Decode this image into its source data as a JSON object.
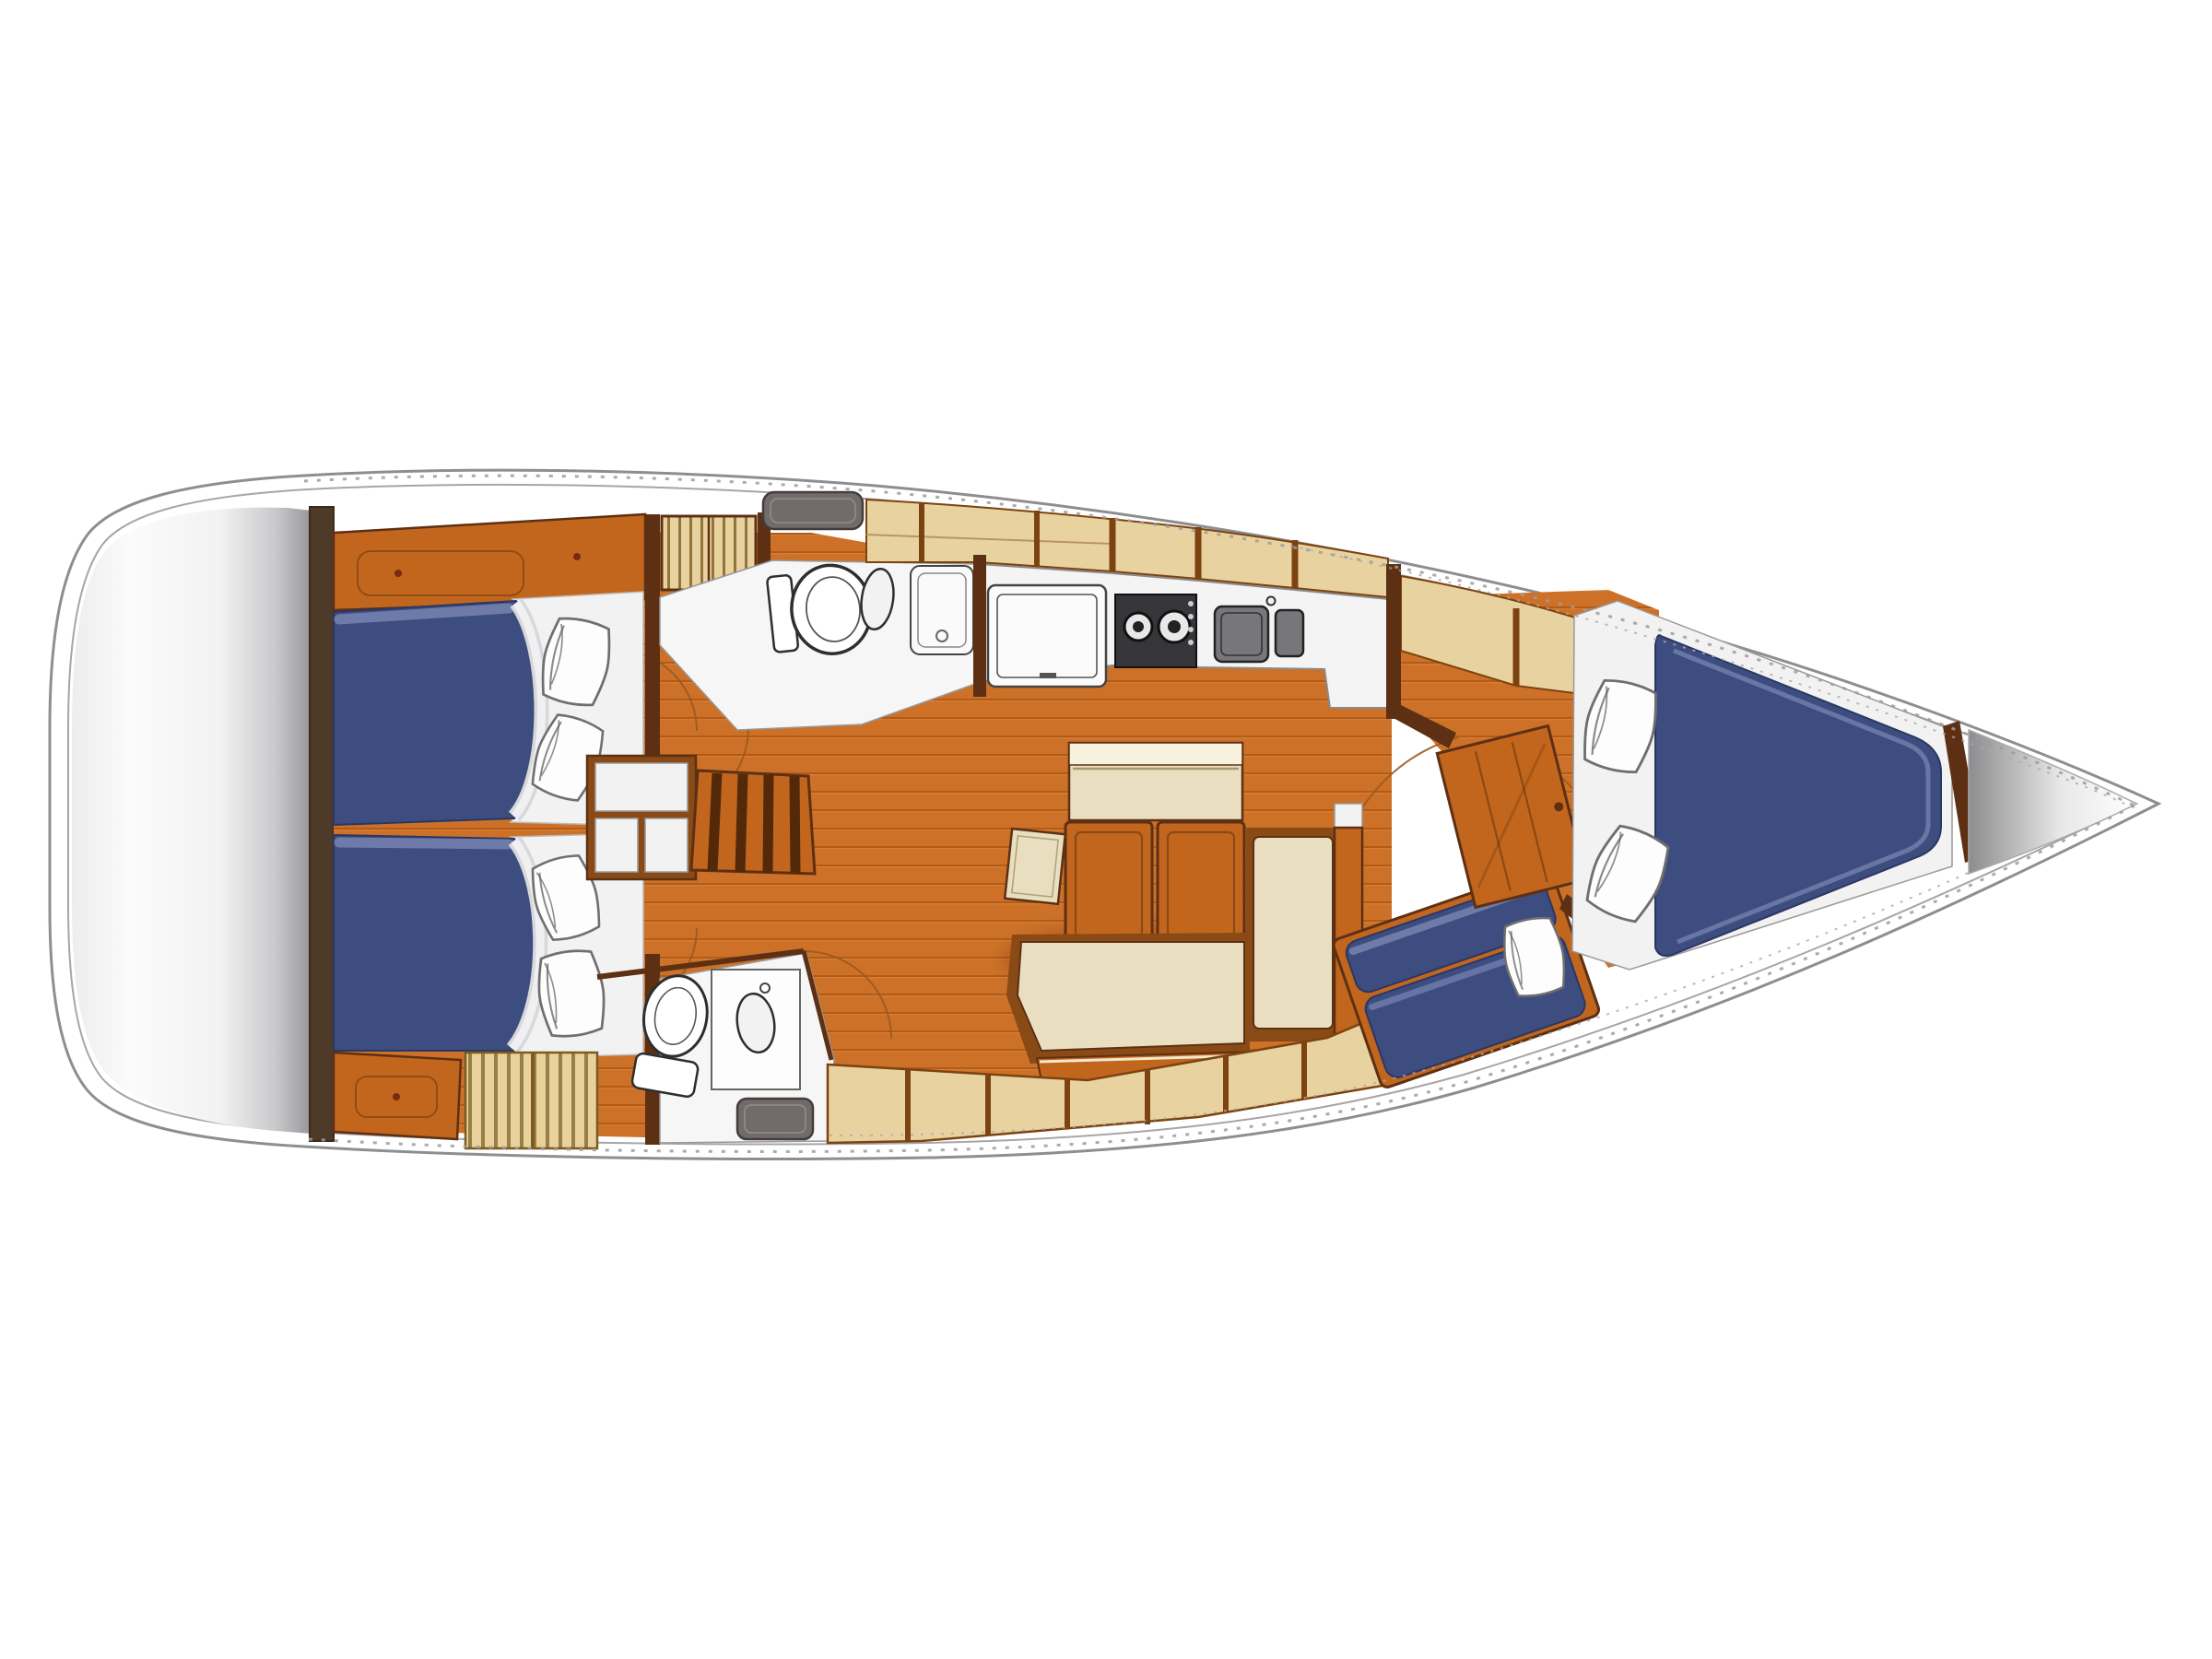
{
  "diagram": {
    "type": "floor-plan",
    "subject": "sailboat-interior-layout-top-view",
    "orientation": {
      "bow": "right",
      "stern": "left"
    }
  },
  "colors": {
    "hull_fill": "#ffffff",
    "platform_light": "#fbfbfb",
    "platform_dark": "#96969a",
    "bulkhead_wood": "#4e3a28",
    "wall_wood": "#5d3014",
    "wood_furniture": "#c2661d",
    "wood_furniture_dark": "#8a4a16",
    "floor_base": "#cd7128",
    "floor_line": "#a85415",
    "locker_beige": "#e8d3a0",
    "locker_beige_dark": "#d9bd7e",
    "locker_divider": "#7c4310",
    "grate_tan": "#e8d19b",
    "grate_line": "#8a7038",
    "berth_navy": "#3e4d7f",
    "berth_navy_hi": "#7381ad",
    "sheet_white": "#f0f0f2",
    "pillow_white": "#fdfdfd",
    "cream": "#e9dfc0",
    "cream_hi": "#f7f1de",
    "fixture_white": "#f6f6f7",
    "counter_white": "#f4f4f5",
    "stove_dark": "#35353a",
    "sink_gray": "#77777a",
    "hatch_gray": "#716c69",
    "white_zone": "#f2f2f3"
  },
  "regions": [
    {
      "id": "swim-platform"
    },
    {
      "id": "transom-bulkhead"
    },
    {
      "id": "aft-cabin-port",
      "items": [
        "double-berth",
        "pillows",
        "headboard-shelf"
      ]
    },
    {
      "id": "aft-cabin-starboard",
      "items": [
        "double-berth",
        "pillows",
        "headboard-shelf",
        "floor-grating"
      ]
    },
    {
      "id": "nav-desk"
    },
    {
      "id": "companionway-stairs"
    },
    {
      "id": "companionway-hatch"
    },
    {
      "id": "hanging-locker"
    },
    {
      "id": "head-port",
      "items": [
        "toilet",
        "washbasin",
        "shower"
      ]
    },
    {
      "id": "head-starboard",
      "items": [
        "toilet",
        "washbasin",
        "vent-hatch"
      ]
    },
    {
      "id": "galley",
      "items": [
        "fridge-lid",
        "two-burner-stove",
        "double-sink",
        "counter",
        "overhead-lockers"
      ]
    },
    {
      "id": "salon",
      "items": [
        "dining-table",
        "folding-chairs",
        "l-settee",
        "mast-stool",
        "hull-side-lockers"
      ]
    },
    {
      "id": "chaise-longue",
      "items": [
        "navy-back-cushion",
        "navy-seat-cushion",
        "pillow"
      ]
    },
    {
      "id": "forward-cabin",
      "items": [
        "door",
        "v-berth",
        "pillows",
        "side-shelf",
        "overhead-lockers"
      ]
    },
    {
      "id": "anchor-locker"
    }
  ]
}
